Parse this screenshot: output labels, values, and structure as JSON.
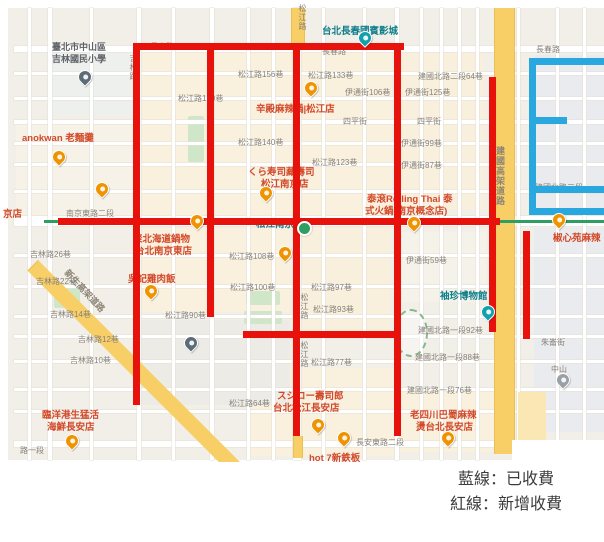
{
  "legend": {
    "lines": [
      "藍線：已收費",
      "紅線：新增收費"
    ],
    "blue_color": "#29a8e0",
    "red_color": "#e8120c"
  },
  "map": {
    "labels": [
      {
        "t": "臺北市中山區",
        "x": 52,
        "y": 40,
        "k": "sc"
      },
      {
        "t": "吉林國民小學",
        "x": 52,
        "y": 52,
        "k": "sc"
      },
      {
        "t": "長春路",
        "x": 150,
        "y": 41,
        "k": "st"
      },
      {
        "t": "長春路",
        "x": 322,
        "y": 46,
        "k": "st"
      },
      {
        "t": "長春路",
        "x": 536,
        "y": 44,
        "k": "st"
      },
      {
        "t": "台北長春國賓影城",
        "x": 322,
        "y": 23,
        "k": "tr"
      },
      {
        "t": "松江路156巷",
        "x": 238,
        "y": 69,
        "k": "st"
      },
      {
        "t": "松江路150巷",
        "x": 178,
        "y": 93,
        "k": "st"
      },
      {
        "t": "松江路140巷",
        "x": 238,
        "y": 137,
        "k": "st"
      },
      {
        "t": "松江路133巷",
        "x": 308,
        "y": 70,
        "k": "st"
      },
      {
        "t": "松江路123巷",
        "x": 312,
        "y": 157,
        "k": "st"
      },
      {
        "t": "建國北路二段64巷",
        "x": 418,
        "y": 71,
        "k": "st"
      },
      {
        "t": "伊通街106巷",
        "x": 345,
        "y": 87,
        "k": "st"
      },
      {
        "t": "伊通街125巷",
        "x": 405,
        "y": 87,
        "k": "st"
      },
      {
        "t": "四平街",
        "x": 343,
        "y": 116,
        "k": "st"
      },
      {
        "t": "四平街",
        "x": 417,
        "y": 116,
        "k": "st"
      },
      {
        "t": "伊通街99巷",
        "x": 401,
        "y": 138,
        "k": "st"
      },
      {
        "t": "伊通街87巷",
        "x": 401,
        "y": 160,
        "k": "st"
      },
      {
        "t": "伊通街59巷",
        "x": 406,
        "y": 255,
        "k": "st"
      },
      {
        "t": "南京東路二段",
        "x": 66,
        "y": 208,
        "k": "st"
      },
      {
        "t": "吉林路26巷",
        "x": 30,
        "y": 249,
        "k": "st"
      },
      {
        "t": "吉林路22巷",
        "x": 36,
        "y": 276,
        "k": "st"
      },
      {
        "t": "吉林路14巷",
        "x": 50,
        "y": 309,
        "k": "st"
      },
      {
        "t": "吉林路12巷",
        "x": 78,
        "y": 334,
        "k": "st"
      },
      {
        "t": "吉林路10巷",
        "x": 70,
        "y": 355,
        "k": "st"
      },
      {
        "t": "松江路108巷",
        "x": 229,
        "y": 251,
        "k": "st"
      },
      {
        "t": "松江路100巷",
        "x": 230,
        "y": 282,
        "k": "st"
      },
      {
        "t": "松江路97巷",
        "x": 311,
        "y": 282,
        "k": "st"
      },
      {
        "t": "松江路93巷",
        "x": 313,
        "y": 304,
        "k": "st"
      },
      {
        "t": "松江路90巷",
        "x": 165,
        "y": 310,
        "k": "st"
      },
      {
        "t": "松江路77巷",
        "x": 311,
        "y": 357,
        "k": "st"
      },
      {
        "t": "松江路64巷",
        "x": 229,
        "y": 398,
        "k": "st"
      },
      {
        "t": "建國北路一段92巷",
        "x": 418,
        "y": 325,
        "k": "st"
      },
      {
        "t": "建國北路一段88巷",
        "x": 415,
        "y": 352,
        "k": "st"
      },
      {
        "t": "建國北路一段76巷",
        "x": 407,
        "y": 385,
        "k": "st"
      },
      {
        "t": "建國北路二段",
        "x": 535,
        "y": 182,
        "k": "st"
      },
      {
        "t": "朱崙街",
        "x": 541,
        "y": 337,
        "k": "st"
      },
      {
        "t": "長安東路二段",
        "x": 356,
        "y": 437,
        "k": "st"
      },
      {
        "t": "路一段",
        "x": 20,
        "y": 445,
        "k": "st"
      },
      {
        "t": "中山",
        "x": 551,
        "y": 364,
        "k": "st"
      },
      {
        "t": "京店",
        "x": 3,
        "y": 206,
        "k": "poi"
      },
      {
        "t": "松江路",
        "x": 297,
        "y": 4,
        "k": "st",
        "v": 1
      },
      {
        "t": "吉林路",
        "x": 128,
        "y": 54,
        "k": "st",
        "v": 1
      },
      {
        "t": "松江路",
        "x": 299,
        "y": 293,
        "k": "st",
        "v": 1
      },
      {
        "t": "松江路",
        "x": 299,
        "y": 341,
        "k": "st",
        "v": 1
      },
      {
        "t": "建國高架道路",
        "x": 494,
        "y": 146,
        "k": "rd",
        "v": 1
      },
      {
        "t": "新生高架道路",
        "x": 58,
        "y": 284,
        "k": "rd",
        "r": 47
      },
      {
        "t": "anokwan 老麵攤",
        "x": 22,
        "y": 130,
        "k": "poi"
      },
      {
        "t": "辛殿麻辣鍋|松江店",
        "x": 256,
        "y": 101,
        "k": "poi"
      },
      {
        "t": "くら寿司藏壽司",
        "x": 248,
        "y": 164,
        "k": "poi"
      },
      {
        "t": "松江南京店",
        "x": 261,
        "y": 176,
        "k": "poi"
      },
      {
        "t": "泰滾Rolling Thai 泰",
        "x": 367,
        "y": 191,
        "k": "poi"
      },
      {
        "t": "式火鍋(南京概念店)",
        "x": 365,
        "y": 203,
        "k": "poi"
      },
      {
        "t": "聚北海道鍋物",
        "x": 133,
        "y": 231,
        "k": "poi"
      },
      {
        "t": "台北南京東店",
        "x": 135,
        "y": 243,
        "k": "poi"
      },
      {
        "t": "吳記雞肉飯",
        "x": 128,
        "y": 271,
        "k": "poi"
      },
      {
        "t": "椒心苑麻辣",
        "x": 553,
        "y": 230,
        "k": "poi"
      },
      {
        "t": "松江南京",
        "x": 256,
        "y": 216,
        "k": "tr"
      },
      {
        "t": "袖珍博物館",
        "x": 440,
        "y": 288,
        "k": "tr"
      },
      {
        "t": "スシロー壽司郎",
        "x": 277,
        "y": 388,
        "k": "poi"
      },
      {
        "t": "台北松江長安店",
        "x": 273,
        "y": 400,
        "k": "poi"
      },
      {
        "t": "老四川巴蜀麻辣",
        "x": 410,
        "y": 407,
        "k": "poi"
      },
      {
        "t": "燙台北長安店",
        "x": 416,
        "y": 419,
        "k": "poi"
      },
      {
        "t": "hot 7新鉄板",
        "x": 309,
        "y": 450,
        "k": "poi"
      },
      {
        "t": "臨洋港生猛活",
        "x": 42,
        "y": 407,
        "k": "poi"
      },
      {
        "t": "海鮮長安店",
        "x": 47,
        "y": 419,
        "k": "poi"
      }
    ],
    "red_segments": [
      {
        "x": 133,
        "y": 43,
        "w": 271,
        "h": 7
      },
      {
        "x": 58,
        "y": 218,
        "w": 442,
        "h": 7
      },
      {
        "x": 243,
        "y": 331,
        "w": 154,
        "h": 7
      },
      {
        "x": 133,
        "y": 43,
        "w": 7,
        "h": 362
      },
      {
        "x": 207,
        "y": 43,
        "w": 7,
        "h": 274
      },
      {
        "x": 293,
        "y": 43,
        "w": 7,
        "h": 393
      },
      {
        "x": 394,
        "y": 46,
        "w": 7,
        "h": 390
      },
      {
        "x": 489,
        "y": 77,
        "w": 7,
        "h": 255
      },
      {
        "x": 523,
        "y": 231,
        "w": 7,
        "h": 108
      }
    ],
    "blue_segments": [
      {
        "x": 529,
        "y": 58,
        "w": 7,
        "h": 157
      },
      {
        "x": 529,
        "y": 58,
        "w": 75,
        "h": 7
      },
      {
        "x": 529,
        "y": 117,
        "w": 38,
        "h": 7
      },
      {
        "x": 529,
        "y": 186,
        "w": 75,
        "h": 7
      },
      {
        "x": 529,
        "y": 208,
        "w": 75,
        "h": 7
      }
    ],
    "metro_line": {
      "x": 44,
      "y": 220,
      "w": 560,
      "h": 3
    },
    "station": {
      "x": 297,
      "y": 221
    },
    "park_oval": {
      "x": 394,
      "y": 309,
      "w": 30,
      "h": 44
    },
    "pins": [
      {
        "k": "food",
        "x": 52,
        "y": 150
      },
      {
        "k": "food",
        "x": 95,
        "y": 182
      },
      {
        "k": "food",
        "x": 190,
        "y": 214
      },
      {
        "k": "food",
        "x": 304,
        "y": 81
      },
      {
        "k": "food",
        "x": 259,
        "y": 186
      },
      {
        "k": "food",
        "x": 278,
        "y": 246
      },
      {
        "k": "food",
        "x": 144,
        "y": 284
      },
      {
        "k": "food",
        "x": 407,
        "y": 216
      },
      {
        "k": "food",
        "x": 552,
        "y": 213
      },
      {
        "k": "food",
        "x": 311,
        "y": 418
      },
      {
        "k": "food",
        "x": 337,
        "y": 431
      },
      {
        "k": "food",
        "x": 441,
        "y": 431
      },
      {
        "k": "food",
        "x": 65,
        "y": 434
      },
      {
        "k": "attr",
        "x": 358,
        "y": 31
      },
      {
        "k": "attr",
        "x": 481,
        "y": 305
      },
      {
        "k": "edu",
        "x": 78,
        "y": 70
      },
      {
        "k": "edu",
        "x": 184,
        "y": 336
      },
      {
        "k": "misc",
        "x": 556,
        "y": 373
      }
    ]
  }
}
